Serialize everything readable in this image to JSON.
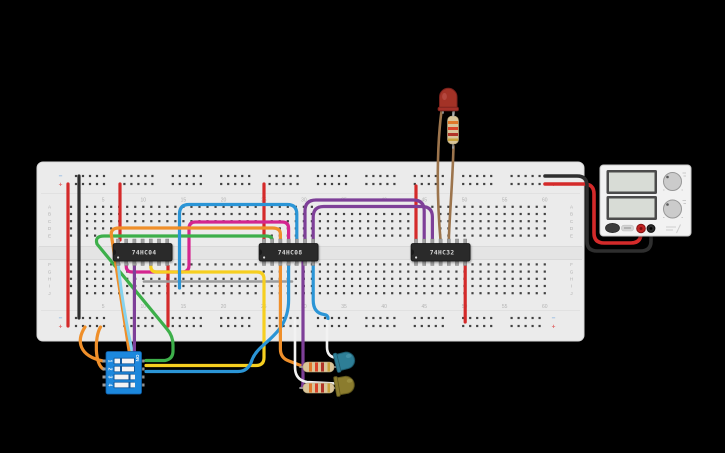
{
  "scene": {
    "background": "#000000"
  },
  "breadboard": {
    "body_color": "#ebebeb",
    "channel_color": "#e4e4e4",
    "hole_color": "#414141",
    "label_color": "#b2b2b2",
    "row_labels": [
      "A",
      "B",
      "C",
      "D",
      "E",
      "F",
      "G",
      "H",
      "I",
      "J"
    ],
    "column_numbers": [
      "5",
      "10",
      "15",
      "20",
      "25",
      "30",
      "35",
      "40",
      "45",
      "50",
      "55",
      "60"
    ],
    "negative_marker": "−",
    "positive_marker": "+",
    "negative_color": "#85b2e0",
    "positive_color": "#e06a6a"
  },
  "ics": [
    {
      "label": "74HC04"
    },
    {
      "label": "74HC08"
    },
    {
      "label": "74HC32"
    }
  ],
  "ic_style": {
    "body_color": "#2b2b2b",
    "pin_color": "#a0a0a0",
    "label_color": "#d9d9d9"
  },
  "dip_switch": {
    "body_color": "#1e88dd",
    "position_labels": [
      "1",
      "2",
      "3",
      "4"
    ],
    "on_label": "ON"
  },
  "leds": [
    {
      "name": "red-led",
      "color": "#a33028",
      "stroke": "#78201b",
      "highlight": "#c25a52"
    },
    {
      "name": "teal-led",
      "color": "#2e7e96",
      "stroke": "#1f5c6e",
      "highlight": "#55a3b8"
    },
    {
      "name": "olive-led",
      "color": "#8b7c2f",
      "stroke": "#645a1e",
      "highlight": "#aca04f"
    }
  ],
  "resistor_style": {
    "body_color": "#d9c59a",
    "body_stroke": "#b3a176",
    "band_colors": [
      "#e0782a",
      "#d9442a",
      "#b03428"
    ],
    "gold_band": "#c8a23c",
    "lead_color": "#9f9f9f"
  },
  "power_supply": {
    "body_color": "#f2f2f2",
    "body_stroke": "#c9c9c9",
    "display_frame": "#4b4b4b",
    "display_screen": "#d8dcd6",
    "knob_color": "#cbcbcb",
    "knob_stroke": "#979797",
    "button_color": "#3c3c3c",
    "chip_color": "#d4d4d4",
    "positive_terminal": "#c22323",
    "negative_terminal": "#2a2a2a"
  },
  "wire_palette": {
    "red": "#d42a2a",
    "black": "#2e2e2e",
    "orange": "#ef8f2a",
    "yellow": "#f6cf20",
    "green": "#3daf4a",
    "blue": "#2b95d6",
    "light_blue": "#85d2ee",
    "purple": "#7e3f98",
    "magenta": "#d4258f",
    "gray": "#9c9c9c",
    "white": "#f2f2f2",
    "brown": "#9c744c"
  },
  "wires": [
    {
      "name": "rail-jumper-positive",
      "color": "red"
    },
    {
      "name": "rail-jumper-negative",
      "color": "black"
    },
    {
      "name": "vcc-74hc04",
      "color": "red"
    },
    {
      "name": "gnd-74hc04",
      "color": "red"
    },
    {
      "name": "vcc-74hc08",
      "color": "red"
    },
    {
      "name": "vcc-74hc32",
      "color": "red"
    },
    {
      "name": "gnd-74hc32",
      "color": "red"
    },
    {
      "name": "row-h-link",
      "color": "gray"
    },
    {
      "name": "inverter-link",
      "color": "magenta"
    },
    {
      "name": "input-b-loop",
      "color": "yellow"
    },
    {
      "name": "input-c-loop",
      "color": "green"
    },
    {
      "name": "gate-link-blue-a",
      "color": "blue"
    },
    {
      "name": "dip-return-blue",
      "color": "blue"
    },
    {
      "name": "gate-link-blue-b",
      "color": "blue"
    },
    {
      "name": "input-a-row-c",
      "color": "orange"
    },
    {
      "name": "dip-supply-1",
      "color": "orange"
    },
    {
      "name": "dip-supply-2",
      "color": "orange"
    },
    {
      "name": "led2-resistor-feed",
      "color": "orange"
    },
    {
      "name": "dip-input-lightblue",
      "color": "light_blue"
    },
    {
      "name": "or-input-1",
      "color": "purple"
    },
    {
      "name": "or-input-2",
      "color": "purple"
    },
    {
      "name": "led3-resistor-feed",
      "color": "purple"
    },
    {
      "name": "dip-input-purple",
      "color": "purple"
    },
    {
      "name": "psu-positive",
      "color": "red"
    },
    {
      "name": "psu-negative",
      "color": "black"
    },
    {
      "name": "led2-ground",
      "color": "white"
    },
    {
      "name": "led3-ground",
      "color": "white"
    },
    {
      "name": "led1-anode",
      "color": "brown"
    },
    {
      "name": "led1-resistor",
      "color": "brown"
    }
  ]
}
